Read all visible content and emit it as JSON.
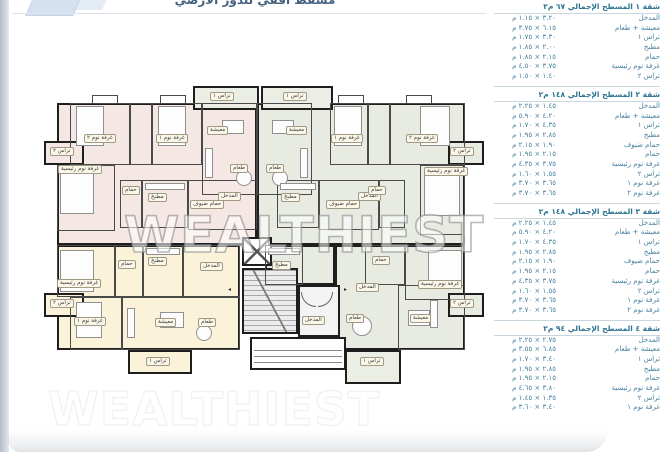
{
  "page": {
    "title_clipped": "مسقط أفقي للدور الأرضي",
    "watermark": "WEALTHIEST"
  },
  "plan": {
    "room_names": {
      "living": "معيشة",
      "dining": "طعام",
      "kitchen": "مطبخ",
      "bath": "حمام",
      "guest_bath": "حمام ضيوف",
      "master": "غرفة نوم رئيسية",
      "bed1": "غرفة نوم ١",
      "bed2": "غرفة نوم ٢",
      "terrace1": "تراس ١",
      "terrace2": "تراس ٢",
      "entrance": "المدخل"
    }
  },
  "panel": {
    "sections": [
      {
        "title": "شقة ١ المسطح الإجمالي ٦٧ م٢",
        "rows": [
          {
            "label": "المدخل",
            "dims": "٣.٢٠ × ١.١٥ م"
          },
          {
            "label": "معيشة + طعام",
            "dims": "٦.١٥ × ٣.٧٥ م"
          },
          {
            "label": "تراس ١",
            "dims": "٣.٣٠ × ١.٧٥ م"
          },
          {
            "label": "مطبخ",
            "dims": "٢.٠٠ × ١.٨٥ م"
          },
          {
            "label": "حمام",
            "dims": "٢.١٥ × ١.٨٥ م"
          },
          {
            "label": "غرفة نوم رئيسية",
            "dims": "٣.٧٥ × ٤.٥٠ م"
          },
          {
            "label": "تراس ٢",
            "dims": "١.٤٠ × ١.٥٠ م"
          }
        ]
      },
      {
        "title": "شقة ٢ المسطح الإجمالي ١٤٨ م٢",
        "rows": [
          {
            "label": "المدخل",
            "dims": "١.٤٥ × ٢.٢٥ م"
          },
          {
            "label": "معيشة + طعام",
            "dims": "٤.٢٠ × ٥.٩٠ م"
          },
          {
            "label": "تراس ١",
            "dims": "٤.٣٥ × ١.٧٠ م"
          },
          {
            "label": "مطبخ",
            "dims": "٢.٨٥ × ١.٩٥ م"
          },
          {
            "label": "حمام ضيوف",
            "dims": "١.٩٠ × ٢.١٥ م"
          },
          {
            "label": "حمام",
            "dims": "٢.١٥ × ١.٩٥ م"
          },
          {
            "label": "غرفة نوم رئيسية",
            "dims": "٣.٧٥ × ٤.٣٥ م"
          },
          {
            "label": "تراس ٢",
            "dims": "١.٥٥ × ١.٦٠ م"
          },
          {
            "label": "غرفة نوم ١",
            "dims": "٣.٦٥ × ٣.٧٠ م"
          },
          {
            "label": "غرفة نوم ٢",
            "dims": "٣.٦٥ × ٣.٧٠ م"
          }
        ]
      },
      {
        "title": "شقة ٣ المسطح الإجمالي ١٤٨ م٢",
        "rows": [
          {
            "label": "المدخل",
            "dims": "١.٤٥ × ٢.٢٥ م"
          },
          {
            "label": "معيشة + طعام",
            "dims": "٤.٢٠ × ٥.٩٠ م"
          },
          {
            "label": "تراس ١",
            "dims": "٤.٣٥ × ١.٧٠ م"
          },
          {
            "label": "مطبخ",
            "dims": "٢.٨٥ × ١.٩٥ م"
          },
          {
            "label": "حمام ضيوف",
            "dims": "١.٩٠ × ٢.١٥ م"
          },
          {
            "label": "حمام",
            "dims": "٢.١٥ × ١.٩٥ م"
          },
          {
            "label": "غرفة نوم رئيسية",
            "dims": "٣.٧٥ × ٤.٣٥ م"
          },
          {
            "label": "تراس ٢",
            "dims": "١.٥٥ × ١.٦٠ م"
          },
          {
            "label": "غرفة نوم ١",
            "dims": "٣.٦٥ × ٣.٧٠ م"
          },
          {
            "label": "غرفة نوم ٢",
            "dims": "٣.٦٥ × ٣.٧٠ م"
          }
        ]
      },
      {
        "title": "شقة ٤ المسطح الإجمالي ٩٤ م٢",
        "rows": [
          {
            "label": "المدخل",
            "dims": "٢.٧٥ × ٢.٢٥ م"
          },
          {
            "label": "معيشة + طعام",
            "dims": "٦.٨٥ × ٣.٥٥ م"
          },
          {
            "label": "تراس ١",
            "dims": "٣.٤٠ × ١.٧٠ م"
          },
          {
            "label": "مطبخ",
            "dims": "٢.٨٥ × ١.٩٥ م"
          },
          {
            "label": "حمام",
            "dims": "٢.١٥ × ١.٩٥ م"
          },
          {
            "label": "غرفة نوم رئيسية",
            "dims": "٣.٨٠ × ٤.٦٥ م"
          },
          {
            "label": "تراس ٢",
            "dims": "١.٣٥ × ١.٤٥ م"
          },
          {
            "label": "غرفة نوم ١",
            "dims": "٣.٤٠ × ٣.٦٠ م"
          }
        ]
      }
    ]
  }
}
